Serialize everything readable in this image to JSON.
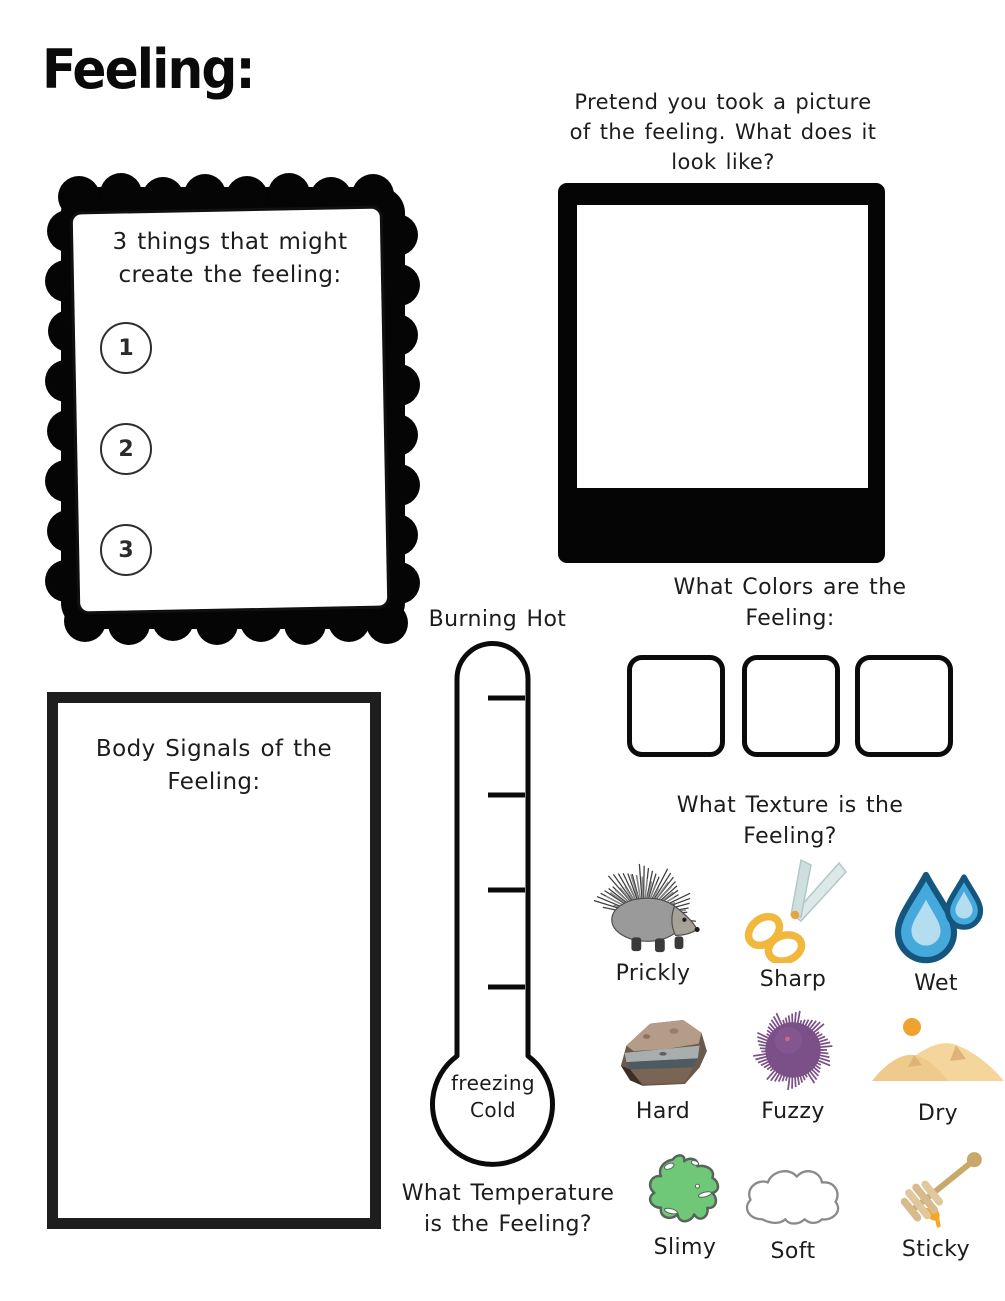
{
  "page_title": "Feeling:",
  "causes_box": {
    "heading": "3 things that might create the feeling:",
    "items": [
      {
        "number": "1"
      },
      {
        "number": "2"
      },
      {
        "number": "3"
      }
    ]
  },
  "picture_box": {
    "prompt": "Pretend you took a picture of the feeling. What does it look like?"
  },
  "colors_box": {
    "heading": "What Colors are the Feeling:",
    "swatch_count": 3
  },
  "texture_box": {
    "heading": "What Texture is the Feeling?",
    "options": [
      {
        "label": "Prickly",
        "icon": "porcupine-icon"
      },
      {
        "label": "Sharp",
        "icon": "scissors-icon"
      },
      {
        "label": "Wet",
        "icon": "water-drops-icon"
      },
      {
        "label": "Hard",
        "icon": "rock-icon"
      },
      {
        "label": "Fuzzy",
        "icon": "fuzzy-pompom-icon"
      },
      {
        "label": "Dry",
        "icon": "sand-dunes-icon"
      },
      {
        "label": "Slimy",
        "icon": "slime-splat-icon"
      },
      {
        "label": "Soft",
        "icon": "cloud-icon"
      },
      {
        "label": "Sticky",
        "icon": "honey-dipper-icon"
      }
    ]
  },
  "thermometer": {
    "top_label": "Burning Hot",
    "bottom_label": "freezing Cold",
    "question": "What Temperature is the Feeling?",
    "tick_count": 4
  },
  "body_signals_box": {
    "heading": "Body Signals of the Feeling:"
  },
  "palette": {
    "ink": "#1c1c1c",
    "frame_black": "#050505",
    "drop_blue": "#45aadb",
    "drop_blue_dark": "#15567e",
    "drop_blue_light": "#b5ddf0",
    "scissor_yellow": "#f2b83e",
    "blade_gray": "#dde8e8",
    "slime_green": "#6fc878",
    "pompom_purple": "#7b4f87",
    "sand": "#f4d69c",
    "sun_orange": "#f0a231",
    "honey_orange": "#f5a623",
    "dipper_tan": "#d9c094"
  }
}
